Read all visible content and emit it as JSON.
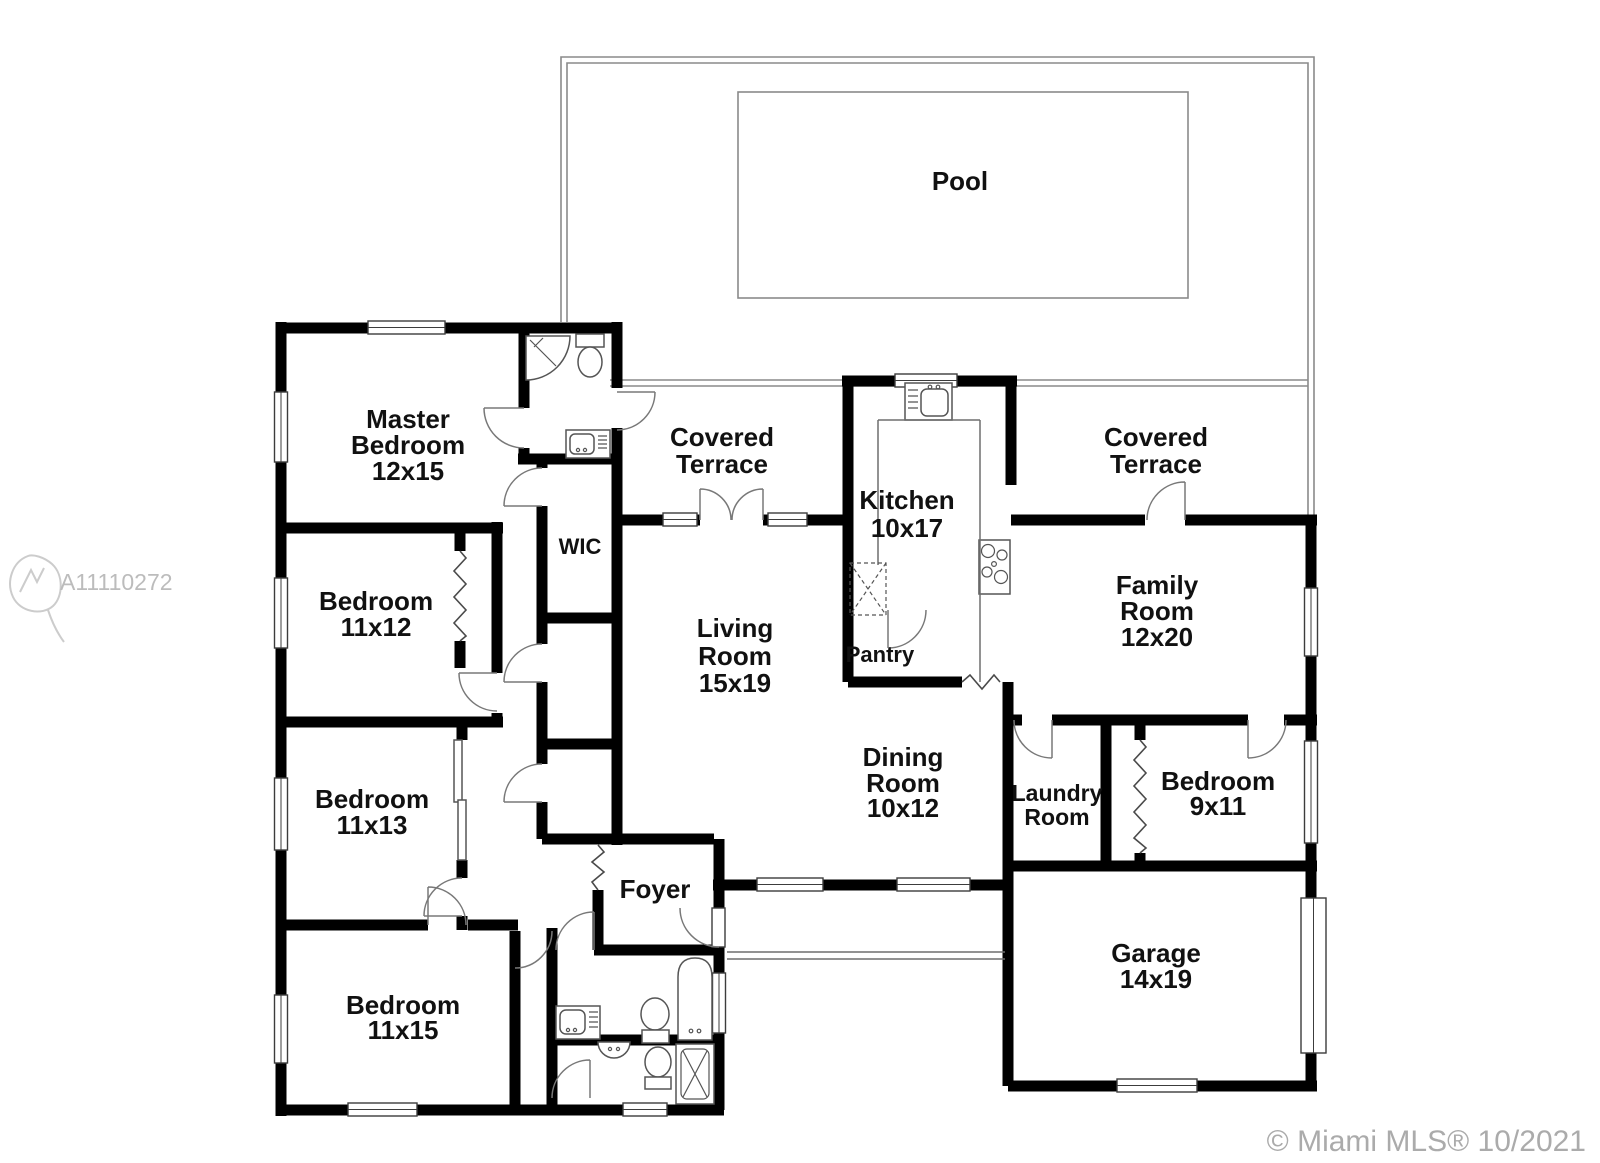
{
  "floor_plan": {
    "watermark": {
      "id": "A11110272"
    },
    "copyright": "© Miami MLS® 10/2021",
    "rooms": {
      "pool": {
        "lines": [
          "Pool"
        ]
      },
      "master_bedroom": {
        "lines": [
          "Master",
          "Bedroom",
          "12x15"
        ]
      },
      "covered_terrace_left": {
        "lines": [
          "Covered",
          "Terrace"
        ]
      },
      "covered_terrace_right": {
        "lines": [
          "Covered",
          "Terrace"
        ]
      },
      "kitchen": {
        "lines": [
          "Kitchen",
          "10x17"
        ]
      },
      "family_room": {
        "lines": [
          "Family",
          "Room",
          "12x20"
        ]
      },
      "living_room": {
        "lines": [
          "Living",
          "Room",
          "15x19"
        ]
      },
      "dining_room": {
        "lines": [
          "Dining",
          "Room",
          "10x12"
        ]
      },
      "pantry": {
        "lines": [
          "Pantry"
        ]
      },
      "wic": {
        "lines": [
          "WIC"
        ]
      },
      "foyer": {
        "lines": [
          "Foyer"
        ]
      },
      "laundry_room": {
        "lines": [
          "Laundry",
          "Room"
        ]
      },
      "bedroom_11x12": {
        "lines": [
          "Bedroom",
          "11x12"
        ]
      },
      "bedroom_11x13": {
        "lines": [
          "Bedroom",
          "11x13"
        ]
      },
      "bedroom_11x15": {
        "lines": [
          "Bedroom",
          "11x15"
        ]
      },
      "bedroom_9x11": {
        "lines": [
          "Bedroom",
          "9x11"
        ]
      },
      "garage": {
        "lines": [
          "Garage",
          "14x19"
        ]
      }
    },
    "colors": {
      "wall": "#000000",
      "background": "#ffffff",
      "text": "#111111",
      "watermark": "#bcbcbc",
      "copyright": "#ababab"
    }
  }
}
